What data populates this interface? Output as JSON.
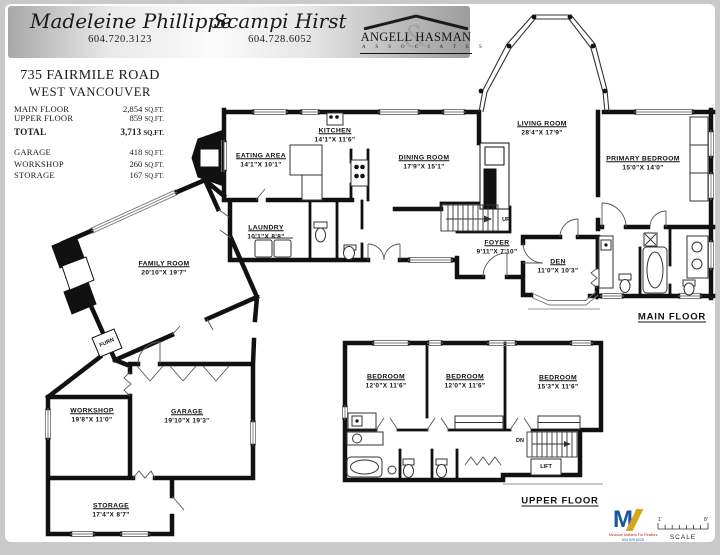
{
  "header": {
    "agent1": {
      "name": "Madeleine Phillippe",
      "phone": "604.720.3123"
    },
    "agent2": {
      "name": "Scampi Hirst",
      "phone": "604.728.6052"
    },
    "brokerage": {
      "name": "ANGELL HASMAN",
      "ampersand": "&",
      "subtitle": "A S S O C I A T E S"
    }
  },
  "listing": {
    "address": "735 FAIRMILE ROAD",
    "city": "WEST VANCOUVER"
  },
  "areas": {
    "unit": "SQ.FT.",
    "rows": [
      {
        "label": "MAIN FLOOR",
        "value": "2,854"
      },
      {
        "label": "UPPER FLOOR",
        "value": "859"
      }
    ],
    "total": {
      "label": "TOTAL",
      "value": "3,713"
    },
    "extra": [
      {
        "label": "GARAGE",
        "value": "418"
      },
      {
        "label": "WORKSHOP",
        "value": "260"
      },
      {
        "label": "STORAGE",
        "value": "167"
      }
    ]
  },
  "floors": {
    "main_label": "MAIN FLOOR",
    "upper_label": "UPPER FLOOR"
  },
  "rooms": {
    "kitchen": {
      "name": "KITCHEN",
      "dims": "14'1\"X 11'6\""
    },
    "eating": {
      "name": "EATING AREA",
      "dims": "14'1\"X 10'1\""
    },
    "dining": {
      "name": "DINING ROOM",
      "dims": "17'9\"X 15'1\""
    },
    "living": {
      "name": "LIVING ROOM",
      "dims": "28'4\"X 17'9\""
    },
    "primary": {
      "name": "PRIMARY BEDROOM",
      "dims": "15'0\"X 14'0\""
    },
    "laundry": {
      "name": "LAUNDRY",
      "dims": "10'1\"X 8'8\""
    },
    "foyer": {
      "name": "FOYER",
      "dims": "9'11\"X 7'10\""
    },
    "den": {
      "name": "DEN",
      "dims": "11'0\"X 10'3\""
    },
    "family": {
      "name": "FAMILY ROOM",
      "dims": "20'10\"X 19'7\""
    },
    "workshop": {
      "name": "WORKSHOP",
      "dims": "19'8\"X 11'0\""
    },
    "garage": {
      "name": "GARAGE",
      "dims": "19'10\"X 19'3\""
    },
    "storage": {
      "name": "STORAGE",
      "dims": "17'4\"X 8'7\""
    },
    "bed1": {
      "name": "BEDROOM",
      "dims": "12'0\"X 11'6\""
    },
    "bed2": {
      "name": "BEDROOM",
      "dims": "12'0\"X 11'6\""
    },
    "bed3": {
      "name": "BEDROOM",
      "dims": "15'3\"X 11'6\""
    }
  },
  "annotations": {
    "up": "UP",
    "dn": "DN",
    "lift": "LIFT",
    "furn": "FURN"
  },
  "footer": {
    "logo_letter": "M",
    "logo_line1": "Measure Masters For Realtors",
    "logo_line2": "604 929 8225",
    "scale_start": "1'",
    "scale_end": "8'",
    "scale_label": "SCALE"
  }
}
